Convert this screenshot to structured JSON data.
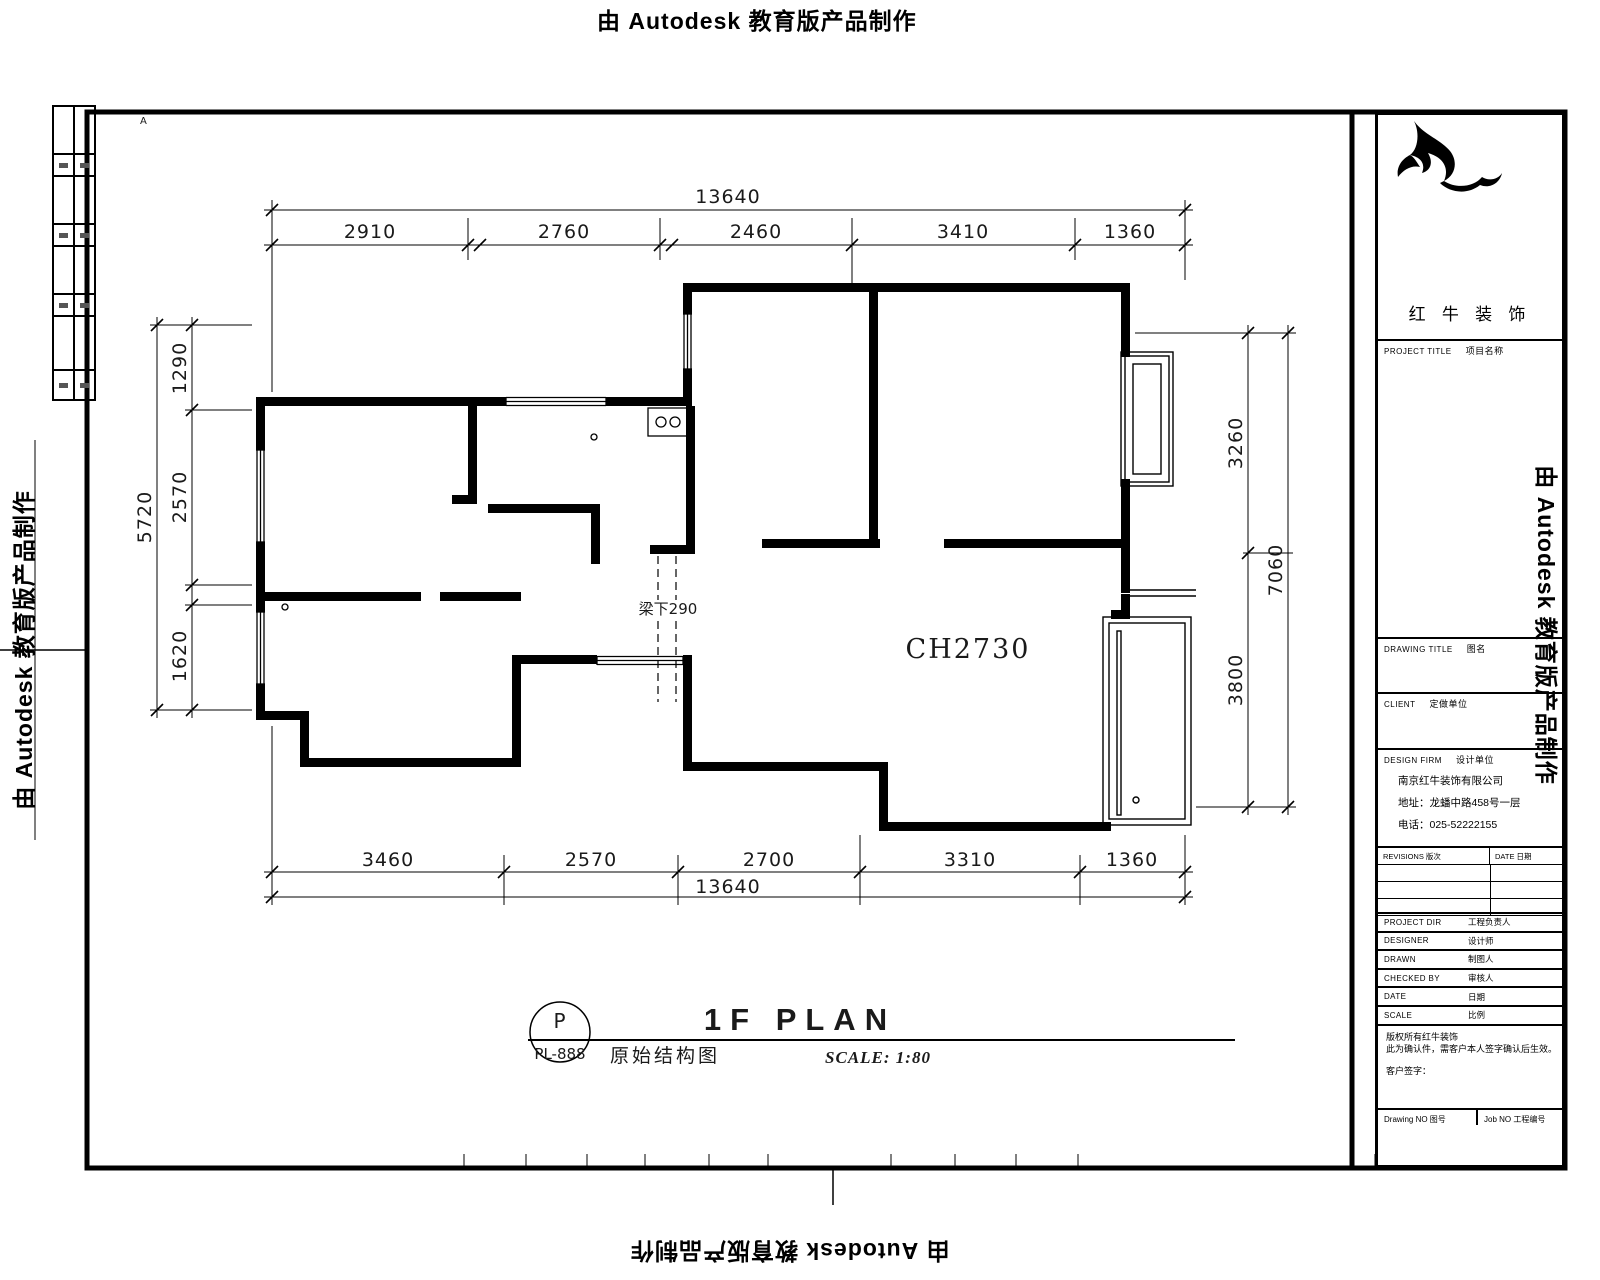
{
  "watermark": {
    "text": "由 Autodesk 教育版产品制作"
  },
  "sheet": {
    "corner_marker": "A"
  },
  "plan": {
    "beam_label": "梁下290",
    "ceiling_label": "CH2730",
    "dims": {
      "top_total": "13640",
      "top_segments": [
        "2910",
        "2760",
        "2460",
        "3410",
        "1360"
      ],
      "bottom_segments": [
        "3460",
        "2570",
        "2700",
        "3310",
        "1360"
      ],
      "bottom_total": "13640",
      "left_total": "5720",
      "left_segments": [
        "1290",
        "2570",
        "1620"
      ],
      "right_segments": [
        "3260",
        "3800"
      ],
      "right_total": "7060"
    }
  },
  "title_bar": {
    "mark": "P",
    "sheet_no": "PL-888",
    "title_en": "1F PLAN",
    "title_cn": "原始结构图",
    "scale": "SCALE: 1:80"
  },
  "title_block": {
    "logo_name": "红 牛 装 饰",
    "project_title": "PROJECT TITLE",
    "project_title_cn": "项目名称",
    "drawing_title": "DRAWING TITLE",
    "drawing_title_cn": "图名",
    "client": "CLIENT",
    "client_cn": "定做单位",
    "design_firm": "DESIGN FIRM",
    "design_firm_cn": "设计单位",
    "company_name": "南京红牛装饰有限公司",
    "company_address": "地址：龙蟠中路458号一层",
    "company_phone": "电话：025-52222155",
    "revisions_label": "REVISIONS 版次",
    "date_label": "DATE 日期",
    "staff_rows": [
      {
        "en": "PROJECT DIR",
        "zh": "工程负责人"
      },
      {
        "en": "DESIGNER",
        "zh": "设计师"
      },
      {
        "en": "DRAWN",
        "zh": "制图人"
      },
      {
        "en": "CHECKED BY",
        "zh": "审核人"
      },
      {
        "en": "DATE",
        "zh": "日期"
      },
      {
        "en": "SCALE",
        "zh": "比例"
      }
    ],
    "note_lines": [
      "版权所有红牛装饰",
      "此为确认件，需客户本人签字确认后生效。",
      "客户签字："
    ],
    "drawing_no_label": "Drawing NO 图号",
    "job_no_label": "Job NO 工程编号"
  }
}
